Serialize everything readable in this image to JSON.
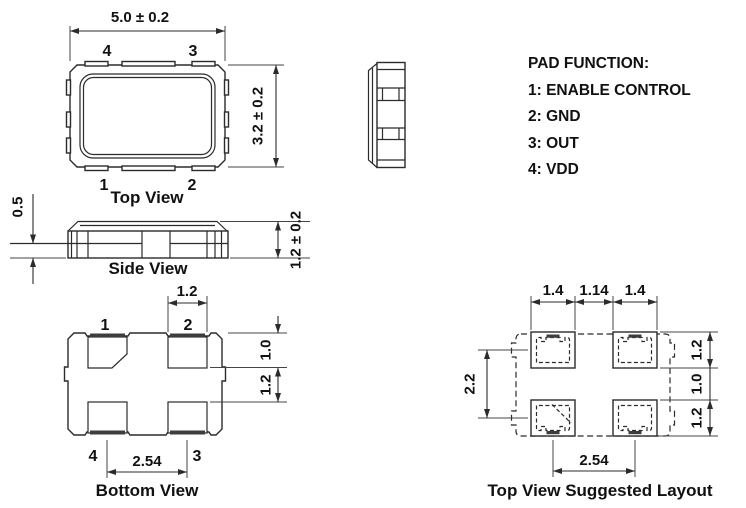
{
  "colors": {
    "line": "#2b2b2b",
    "dim_line": "#454545",
    "text": "#111111",
    "pad_bar_fill": "#3d3d3d",
    "background": "#ffffff"
  },
  "pad_function": {
    "title": "PAD FUNCTION:",
    "items": [
      {
        "label": "1: ENABLE CONTROL"
      },
      {
        "label": "2: GND"
      },
      {
        "label": "3: OUT"
      },
      {
        "label": "4: VDD"
      }
    ]
  },
  "top_view": {
    "caption": "Top View",
    "dims": {
      "width": "5.0 ± 0.2",
      "height": "3.2 ± 0.2"
    },
    "pad_labels": {
      "top_left": "4",
      "top_right": "3",
      "bottom_left": "1",
      "bottom_right": "2"
    }
  },
  "side_view": {
    "caption": "Side View",
    "dims": {
      "base_height": "0.5",
      "total_height": "1.2 ± 0.2"
    }
  },
  "bottom_view": {
    "caption": "Bottom View",
    "dims": {
      "pad_width": "1.2",
      "pad_offset": "1.0",
      "pad_height": "1.2",
      "pad_pitch": "2.54"
    },
    "pad_labels": {
      "top_left": "1",
      "top_right": "2",
      "bottom_left": "4",
      "bottom_right": "3"
    }
  },
  "layout_view": {
    "caption": "Top View Suggested Layout",
    "dims": {
      "pad_width_left": "1.4",
      "pad_gap": "1.14",
      "pad_width_right": "1.4",
      "row_pitch": "2.2",
      "pad_height_top": "1.2",
      "row_gap": "1.0",
      "pad_height_bottom": "1.2",
      "pad_pitch": "2.54"
    }
  }
}
